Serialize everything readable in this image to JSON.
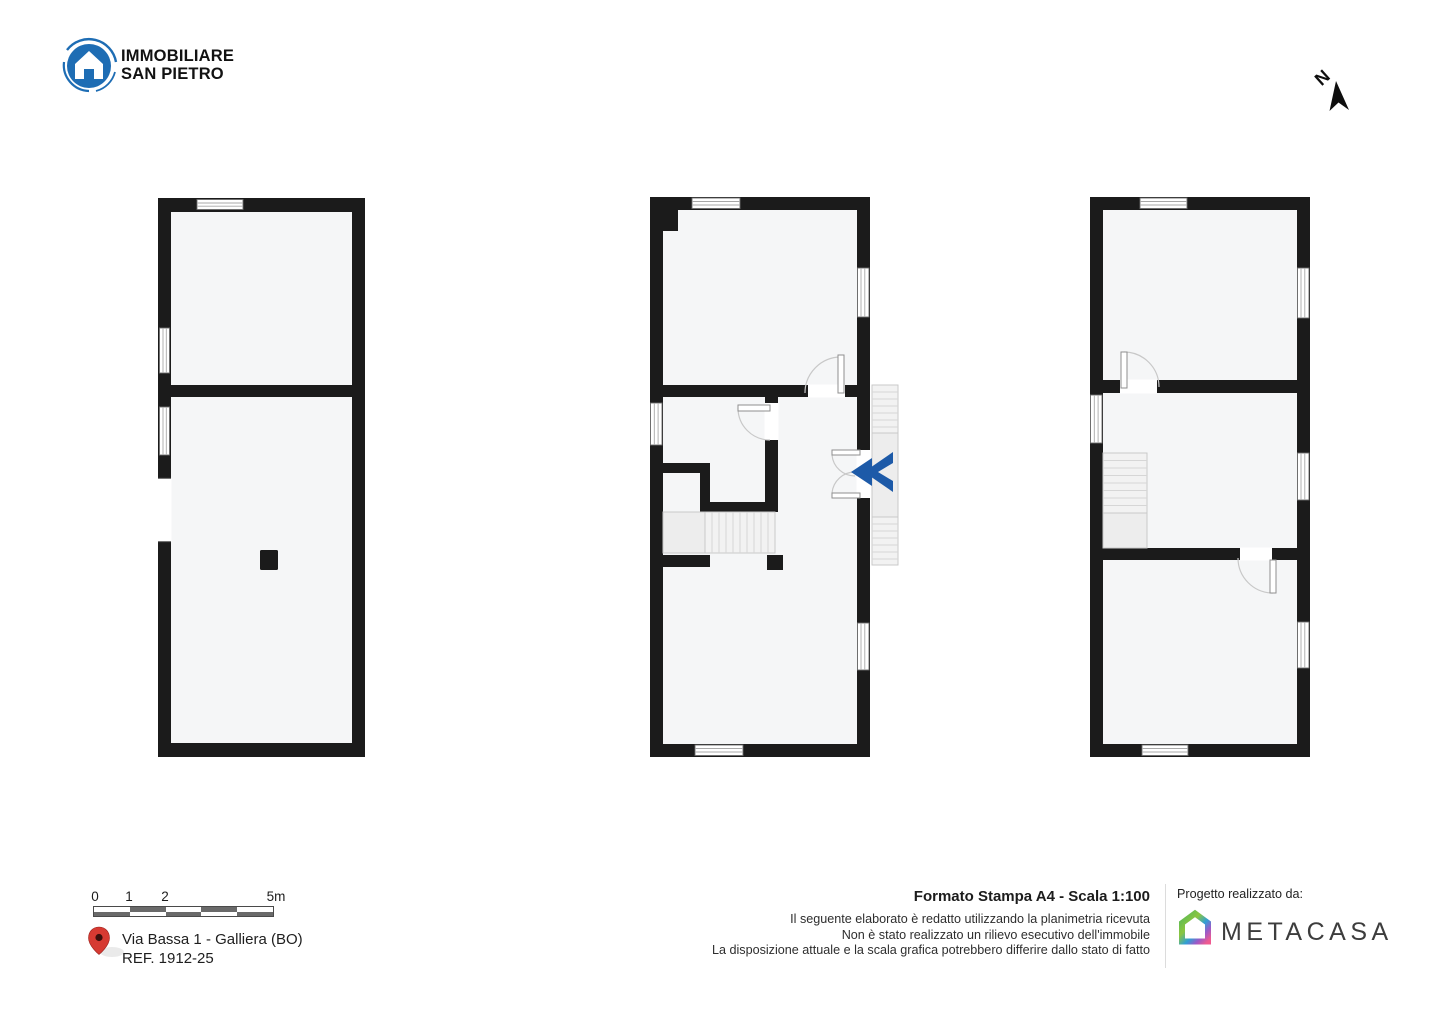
{
  "header": {
    "brand": {
      "line1": "IMMOBILIARE",
      "line2": "SAN PIETRO"
    },
    "compass_label": "N"
  },
  "footer": {
    "scale_bar": {
      "tick0": "0",
      "tick1": "1",
      "tick2": "2",
      "tick5": "5m"
    },
    "location": {
      "address": "Via Bassa 1 - Galliera (BO)",
      "reference": "REF. 1912-25"
    },
    "print_info": {
      "title": "Formato Stampa A4 - Scala 1:100",
      "disclaimer1": "Il seguente elaborato è redatto utilizzando la planimetria ricevuta",
      "disclaimer2": "Non è stato realizzato un rilievo esecutivo dell'immobile",
      "disclaimer3": "La disposizione attuale e la scala grafica potrebbero differire dallo stato di fatto"
    },
    "credits": {
      "label": "Progetto realizzato da:",
      "brand": "METACASA"
    }
  },
  "icons": {
    "brand_logo": "house-in-circle-icon",
    "north_arrow": "north-arrow-icon",
    "map_pin": "map-pin-icon",
    "plan_watermark": "double-chevron-icon",
    "credit_logo": "metacasa-house-icon"
  },
  "colors": {
    "wall": "#1b1b1b",
    "floor": "#f5f6f7",
    "brand_blue": "#1e6db4",
    "watermark_blue": "#1d5aa8",
    "pin_red": "#d63a32"
  }
}
